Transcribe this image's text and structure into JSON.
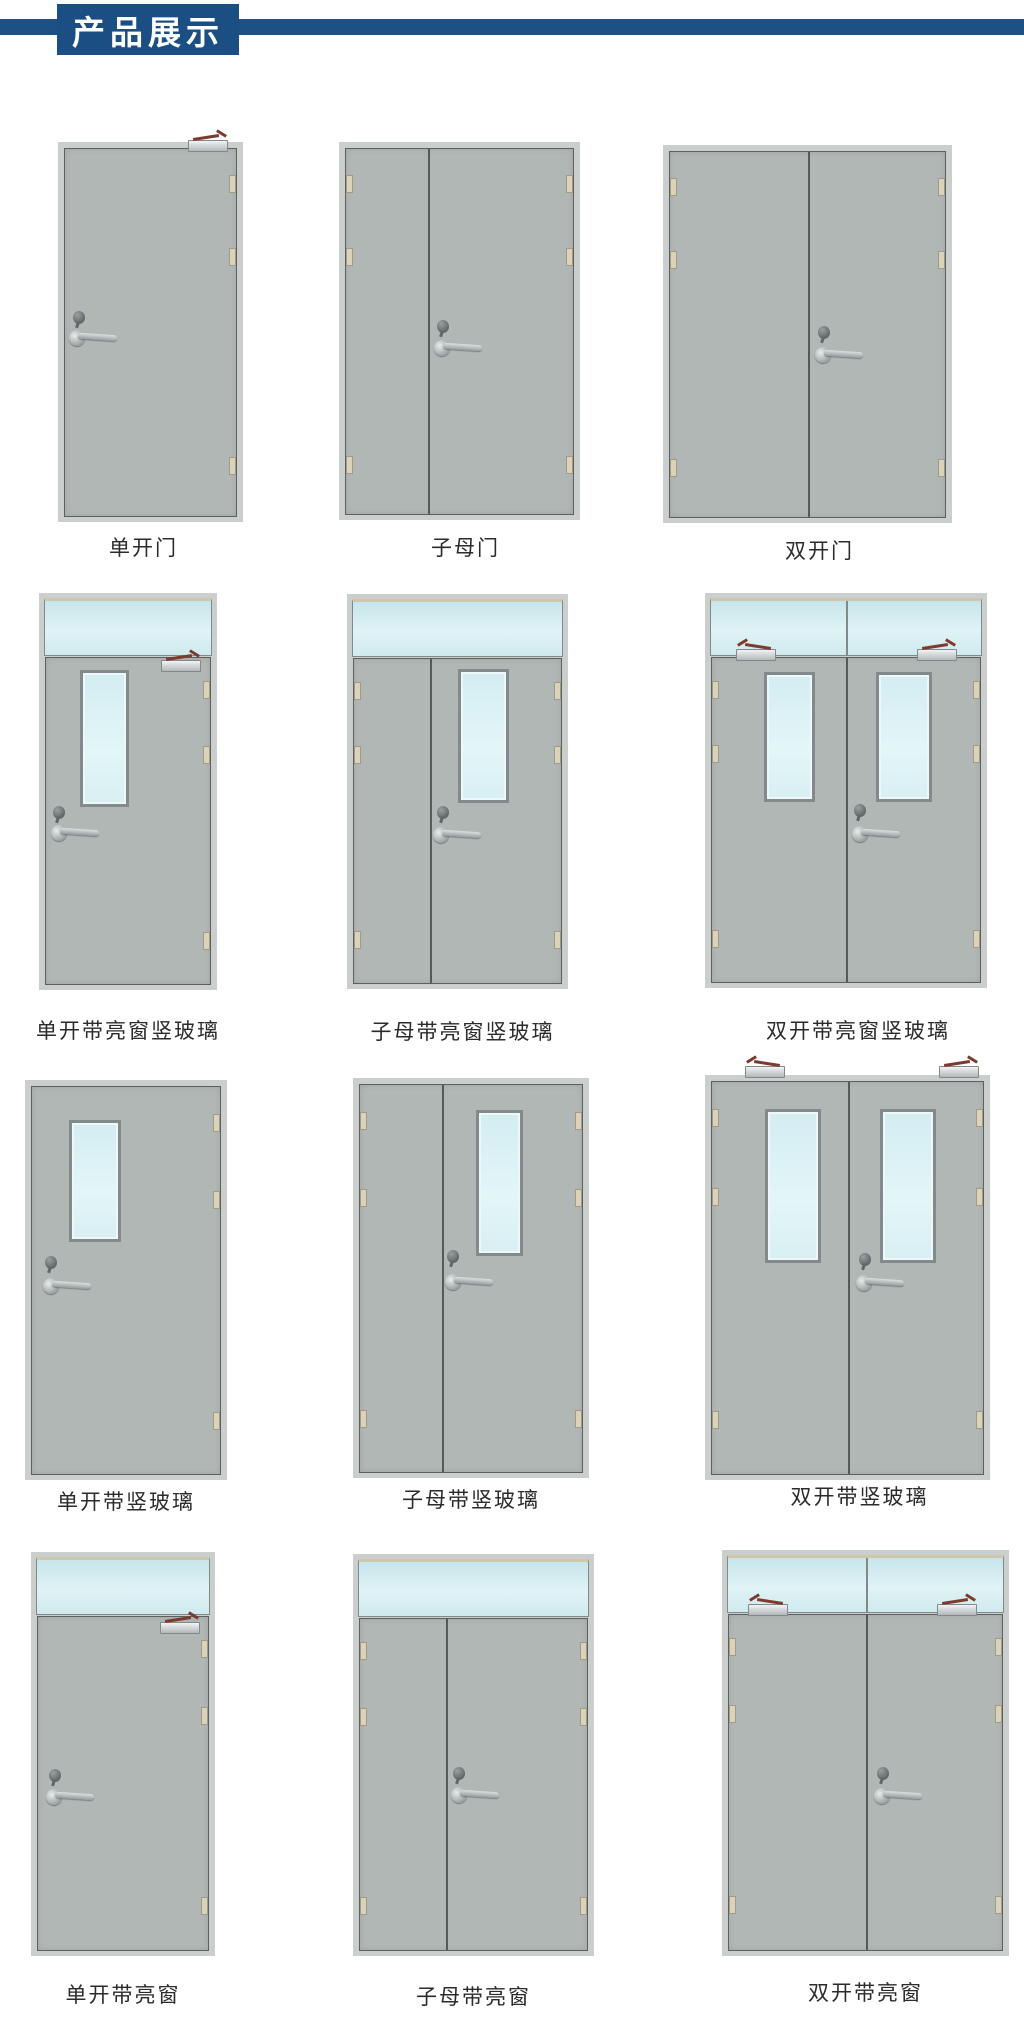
{
  "header": {
    "title": "产品展示"
  },
  "colors": {
    "accent_blue": "#1c5185",
    "badge_blue": "#1b4f83",
    "door_leaf_gray": "#b1b7b5",
    "door_frame_gray": "#cacecd",
    "outline_gray": "#5c615f",
    "vision_glass_blue": "#d9eff3",
    "transom_glass_blue": "#cde8ed",
    "hinge_beige": "#d9d0b8",
    "closer_silver": "#c3c8ca",
    "closer_arm_maroon": "#7c3b2e",
    "label_text": "#2b2b2b",
    "page_background": "#ffffff"
  },
  "products": {
    "rows": [
      {
        "labels": [
          "单开门",
          "子母门",
          "双开门"
        ]
      },
      {
        "labels": [
          "单开带亮窗竖玻璃",
          "子母带亮窗竖玻璃",
          "双开带亮窗竖玻璃"
        ]
      },
      {
        "labels": [
          "单开带竖玻璃",
          "子母带竖玻璃",
          "双开带竖玻璃"
        ]
      },
      {
        "labels": [
          "单开带亮窗",
          "子母带亮窗",
          "双开带亮窗"
        ]
      }
    ]
  }
}
